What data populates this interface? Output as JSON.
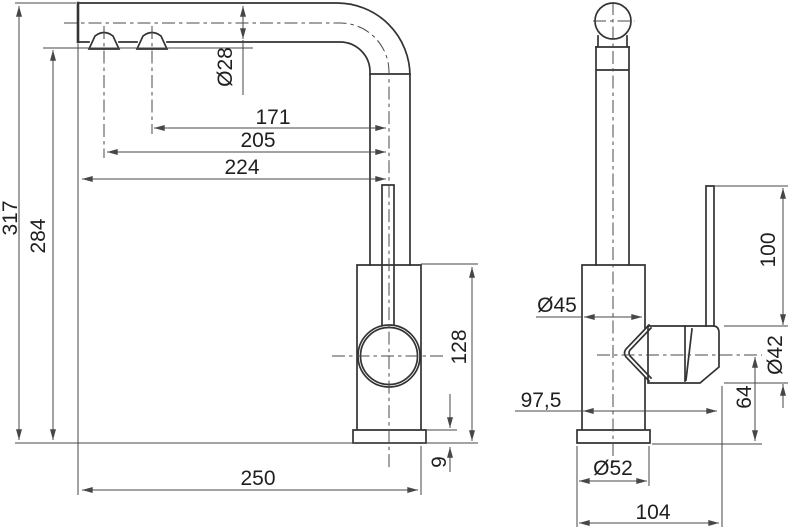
{
  "drawing": {
    "kind": "faucet-dimension-drawing",
    "front_view": {
      "dim_total_height": "317",
      "dim_outlet_height": "284",
      "dim_spout_tube_diameter": "Ø28",
      "dim_outlet2_offset": "171",
      "dim_outlet1_offset": "205",
      "dim_spout_reach": "224",
      "dim_body_height": "128",
      "dim_base_thickness": "9",
      "dim_overall_depth": "250"
    },
    "side_view": {
      "dim_body_diameter": "Ø45",
      "dim_lever_length": "100",
      "dim_handle_diameter": "Ø42",
      "dim_depth_with_handle": "97,5",
      "dim_handle_axis_height": "64",
      "dim_base_diameter": "Ø52",
      "dim_base_depth": "104"
    },
    "colors": {
      "object_line": "#333333",
      "dimension_line": "#474747",
      "text": "#1f1f1f",
      "background": "#ffffff"
    }
  }
}
